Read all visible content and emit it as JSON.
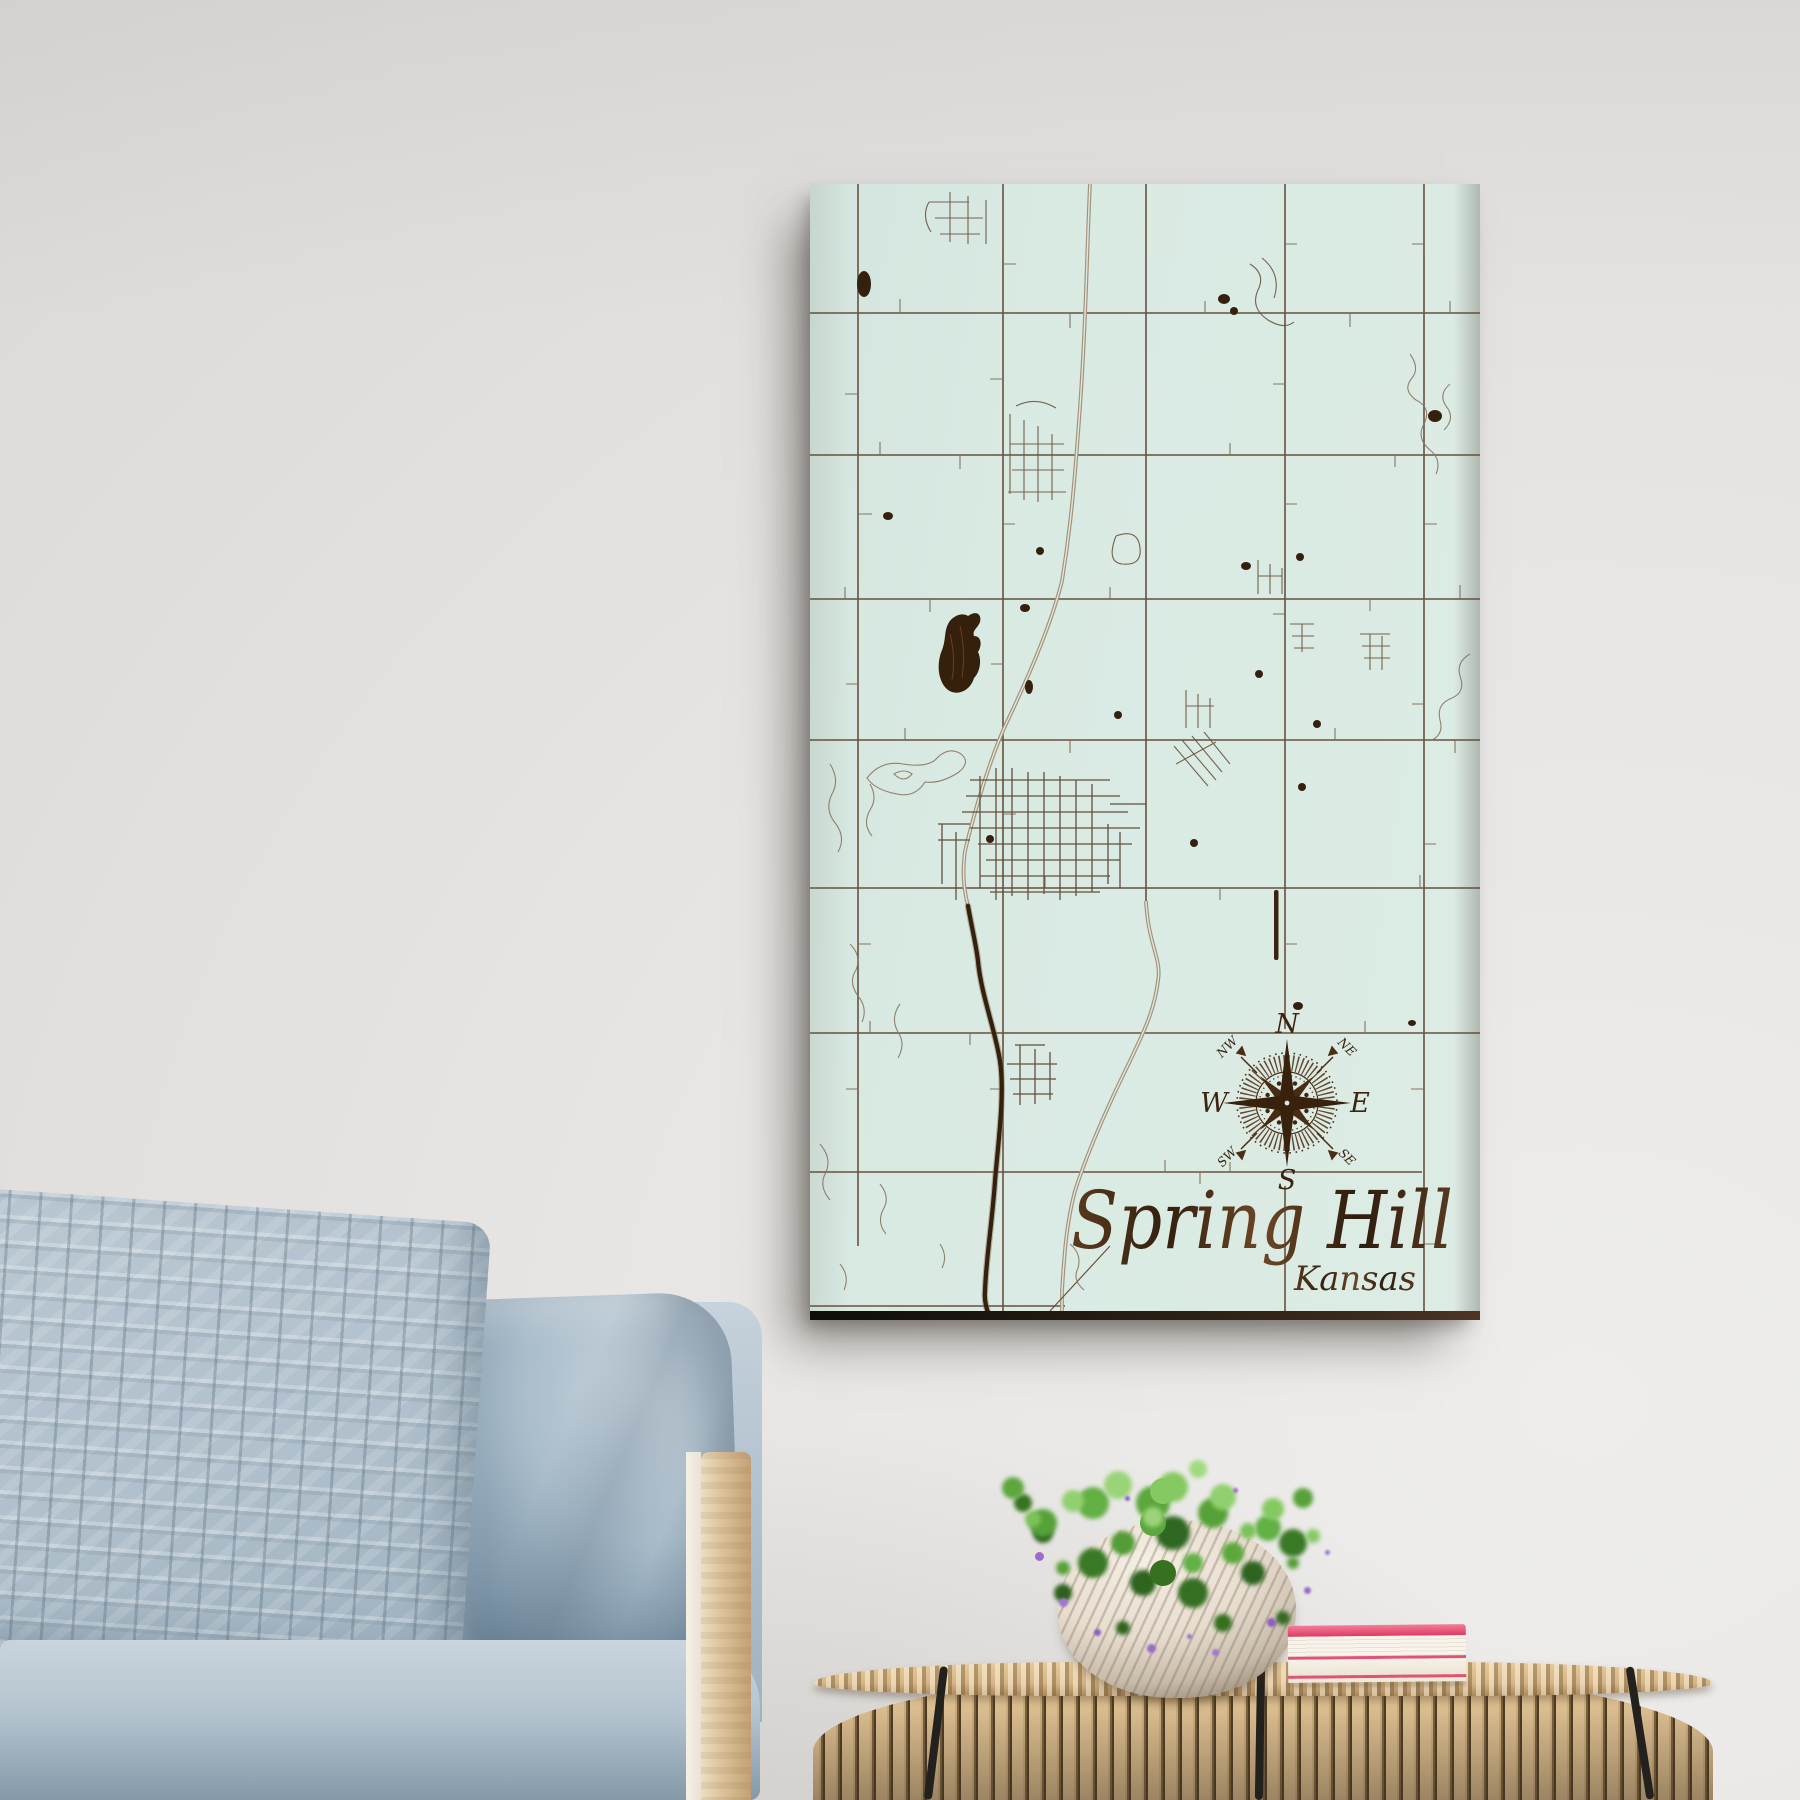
{
  "scene": {
    "description": "Lifestyle photo of an engraved wood street map hung on a wall above a sofa and a rattan side table",
    "wall_color": "#e2e0de"
  },
  "map": {
    "title": "Spring Hill",
    "subtitle": "Kansas",
    "style": {
      "panel_color": "#d9eae3",
      "engraving_dark": "#35200e",
      "engraving_mid": "#6a523c",
      "engraving_light": "#8a7560",
      "edge_color": "#1d1712"
    },
    "compass": {
      "n": "N",
      "e": "E",
      "s": "S",
      "w": "W",
      "nw": "NW",
      "ne": "NE",
      "sw": "SW",
      "se": "SE"
    }
  },
  "furniture": {
    "sofa": {
      "fabric_color": "#b5c3cf",
      "knit_pillow_color": "#b2c1cc",
      "smooth_pillow_color": "#9fb3c2",
      "frame_wood_color": "#dcc29c"
    },
    "table": {
      "rattan_color": "#dcbd8c",
      "strap_color": "#22211e"
    },
    "plant": {
      "foliage_colors": [
        "#85c962",
        "#5ca83d",
        "#37701f"
      ],
      "flower_color": "#9b6ccb",
      "pot_color": "#e9e0d3"
    },
    "books": {
      "top_cover_color": "#e64e72",
      "pages_color": "#f8f4eb",
      "bottom_cover_color": "#f6f1e7"
    }
  }
}
